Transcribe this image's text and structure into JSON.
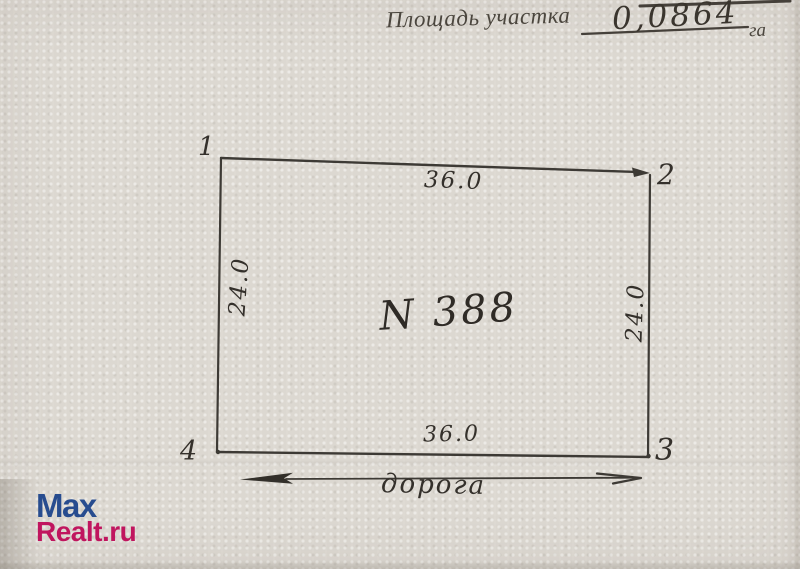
{
  "header": {
    "area_label": "Площадь участка",
    "area_value": "0,0864",
    "area_unit": "га"
  },
  "plot": {
    "number_label": "N 388",
    "corner_labels": [
      "1",
      "2",
      "3",
      "4"
    ],
    "dimensions": {
      "top": "36.0",
      "bottom": "36.0",
      "left": "24.0",
      "right": "24.0"
    },
    "road_label": "дорога"
  },
  "watermark": {
    "line1": "Max",
    "line2": "Realt.ru",
    "line1_color": "#274c8f",
    "line2_color": "#c0155e"
  },
  "colors": {
    "paper": "#dcd8d1",
    "ink": "#3d3a35"
  }
}
